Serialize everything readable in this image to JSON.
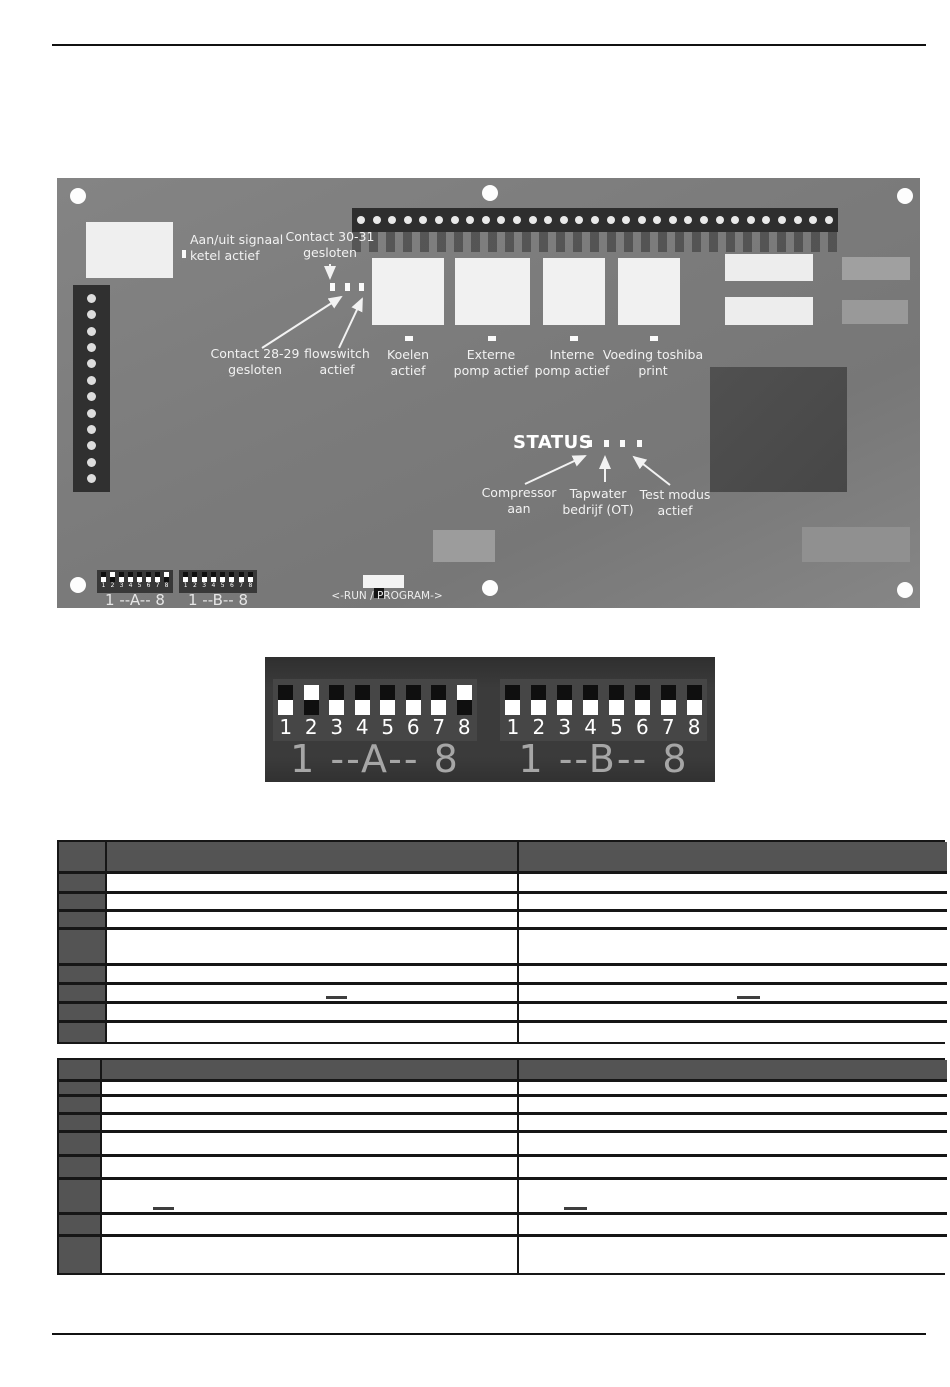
{
  "pcb": {
    "labels": {
      "aan_uit": [
        "Aan/uit signaal",
        "ketel actief"
      ],
      "contact_30_31": [
        "Contact 30-31",
        "gesloten"
      ],
      "contact_28_29": [
        "Contact 28-29",
        "gesloten"
      ],
      "flowswitch": [
        "flowswitch",
        "actief"
      ],
      "koelen": [
        "Koelen",
        "actief"
      ],
      "externe_pomp": [
        "Externe",
        "pomp actief"
      ],
      "interne_pomp": [
        "Interne",
        "pomp actief"
      ],
      "voeding": [
        "Voeding toshiba",
        "print"
      ],
      "status": "STATUS",
      "compressor": [
        "Compressor",
        "aan"
      ],
      "tapwater": [
        "Tapwater",
        "bedrijf (OT)"
      ],
      "test_modus": [
        "Test modus",
        "actief"
      ],
      "run_program": "<-RUN / PROGRAM->"
    },
    "pin_header": {
      "pins": 31
    },
    "left_connector": {
      "pins": 12
    },
    "dip_a": {
      "label": "1 --A-- 8",
      "numbers": [
        "1",
        "2",
        "3",
        "4",
        "5",
        "6",
        "7",
        "8"
      ],
      "states": [
        "down",
        "up",
        "down",
        "down",
        "down",
        "down",
        "down",
        "up"
      ]
    },
    "dip_b": {
      "label": "1 --B-- 8",
      "numbers": [
        "1",
        "2",
        "3",
        "4",
        "5",
        "6",
        "7",
        "8"
      ],
      "states": [
        "down",
        "down",
        "down",
        "down",
        "down",
        "down",
        "down",
        "down"
      ]
    }
  },
  "dip_detail": {
    "block_a": {
      "label": "1 --A-- 8",
      "numbers": [
        "1",
        "2",
        "3",
        "4",
        "5",
        "6",
        "7",
        "8"
      ],
      "states": [
        "down",
        "up",
        "down",
        "down",
        "down",
        "down",
        "down",
        "up"
      ]
    },
    "block_b": {
      "label": "1 --B-- 8",
      "numbers": [
        "1",
        "2",
        "3",
        "4",
        "5",
        "6",
        "7",
        "8"
      ],
      "states": [
        "down",
        "down",
        "down",
        "down",
        "down",
        "down",
        "down",
        "down"
      ]
    }
  },
  "tables": [
    {
      "name": "dip-table-a",
      "x": 57,
      "y": 840,
      "width": 888,
      "header_height": 32,
      "col_widths": [
        48,
        412,
        428
      ],
      "header_cells": [
        "",
        "",
        ""
      ],
      "rows": [
        {
          "h": 20,
          "cells": [
            "",
            "",
            ""
          ]
        },
        {
          "h": 18,
          "cells": [
            "",
            "",
            ""
          ]
        },
        {
          "h": 18,
          "cells": [
            "",
            "",
            ""
          ]
        },
        {
          "h": 36,
          "cells": [
            "",
            "",
            ""
          ]
        },
        {
          "h": 19,
          "cells": [
            "",
            "",
            ""
          ]
        },
        {
          "h": 19,
          "cells": [
            "",
            "",
            ""
          ]
        },
        {
          "h": 19,
          "cells": [
            "",
            "",
            ""
          ]
        },
        {
          "h": 19,
          "cells": [
            "",
            "",
            ""
          ]
        }
      ],
      "dashes": [
        {
          "row": 5,
          "col": 1,
          "left": 219,
          "width": 21
        },
        {
          "row": 5,
          "col": 2,
          "left": 218,
          "width": 23
        }
      ]
    },
    {
      "name": "dip-table-b",
      "x": 57,
      "y": 1058,
      "width": 888,
      "header_height": 22,
      "col_widths": [
        43,
        417,
        428
      ],
      "header_cells": [
        "",
        "",
        ""
      ],
      "rows": [
        {
          "h": 15,
          "cells": [
            "",
            "",
            ""
          ]
        },
        {
          "h": 18,
          "cells": [
            "",
            "",
            ""
          ]
        },
        {
          "h": 18,
          "cells": [
            "",
            "",
            ""
          ]
        },
        {
          "h": 24,
          "cells": [
            "",
            "",
            ""
          ]
        },
        {
          "h": 23,
          "cells": [
            "",
            "",
            ""
          ]
        },
        {
          "h": 35,
          "cells": [
            "",
            "",
            ""
          ]
        },
        {
          "h": 22,
          "cells": [
            "",
            "",
            ""
          ]
        },
        {
          "h": 36,
          "cells": [
            "",
            "",
            ""
          ]
        }
      ],
      "dashes": [
        {
          "row": 5,
          "col": 1,
          "left": 51,
          "width": 21
        },
        {
          "row": 5,
          "col": 2,
          "left": 45,
          "width": 23
        }
      ]
    }
  ],
  "colors": {
    "pcb_base": "#7e7e7e",
    "table_dark_cell": "#545454",
    "table_border": "#161616",
    "annotation_text": "#f2f2f2"
  }
}
